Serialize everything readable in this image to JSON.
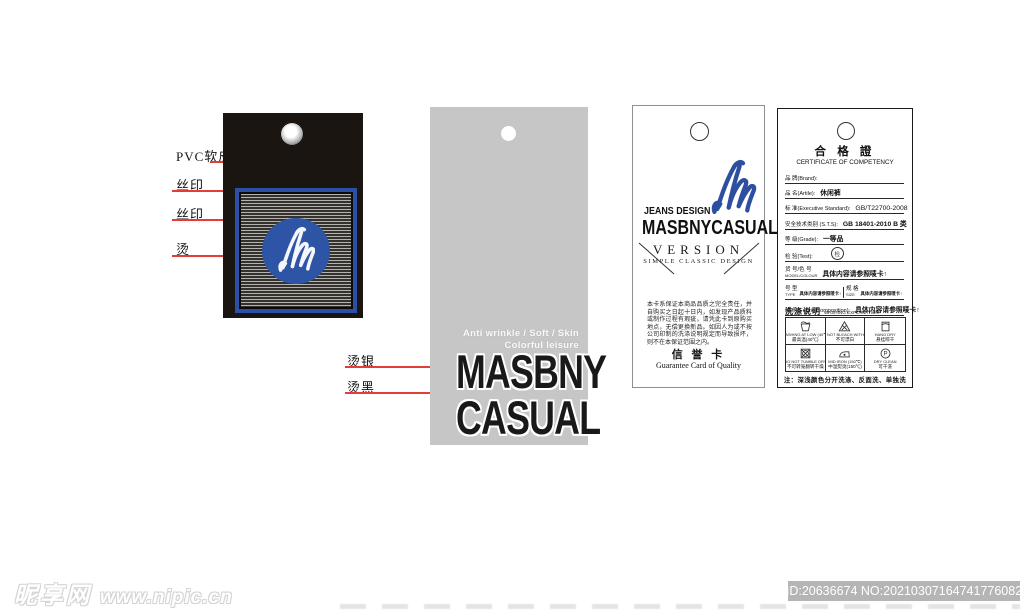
{
  "annotations": {
    "tag1": [
      {
        "label": "PVC软皮"
      },
      {
        "label": "丝印"
      },
      {
        "label": "丝印"
      },
      {
        "label": "烫"
      }
    ],
    "tag2": [
      {
        "label": "烫银"
      },
      {
        "label": "烫黑"
      }
    ]
  },
  "tag2": {
    "tagline_line1": "Anti wrinkle / Soft / Skin",
    "tagline_line2": "Colorful leisure",
    "brand_line1": "MASBNY",
    "brand_line2": "CASUAL"
  },
  "tag3": {
    "kicker": "JEANS DESIGN",
    "brand": "MASBNYCASUAL",
    "version": "VERSION",
    "slogan": "SIMPLE CLASSIC DESIGN",
    "guarantee_text": "本卡系保证本商品品质之完全责任，并自购买之日起十日内，如发现产品质料或制作过程有瑕疵，请凭此卡到原购买地点，无偿更换新品。如因人为或不按公司印制的洗涤说明规定而导致损坏，则不在本保证范围之内。",
    "card_title": "信 誉 卡",
    "card_subtitle": "Guarantee Card of Quality"
  },
  "tag4": {
    "title": "合 格 證",
    "subtitle": "CERTIFICATE OF COMPETENCY",
    "fields": [
      {
        "label": "品 牌(Brand):",
        "value": ""
      },
      {
        "label": "品 名(Artile):",
        "value": "休闲裤"
      },
      {
        "label": "标 准(Executive Standard):",
        "value": "GB/T22700-2008"
      },
      {
        "label": "安全技术类别 (S.T.S):",
        "value": "GB 18401-2010 B 类"
      },
      {
        "label": "等 级(Grade):",
        "value": "一等品"
      },
      {
        "label": "检 验(Test):",
        "value": "检"
      },
      {
        "label": "货 号/色 号",
        "label_sub": "MODEL/COLOUR",
        "value": "具体内容请参照唛卡↑"
      },
      {
        "label": "号 型",
        "label_sub": "TYPE",
        "value": "具体内容请参照唛卡↑"
      },
      {
        "label": "规 格",
        "label_sub": "SIZE",
        "value": "具体内容请参照唛卡↑"
      },
      {
        "label": "成 份(Fabric Composition):",
        "value": "具体内容请参照唛卡↑"
      }
    ],
    "washing_title": "洗涤说明",
    "washing_subtitle": "WASHING EXPLANATION",
    "washing_icons": [
      {
        "icon": "wash-tub-40-icon",
        "en": "WASHING AT LOW (40℃)",
        "zh": "最高温(40℃)"
      },
      {
        "icon": "do-not-bleach-icon",
        "en": "DO NOT BLEACH WITH CL",
        "zh": "不可漂白"
      },
      {
        "icon": "hang-dry-icon",
        "en": "HANG DRY",
        "zh": "悬挂晾干"
      },
      {
        "icon": "do-not-tumble-dry-icon",
        "en": "DO NOT TUMBLE DRY",
        "zh": "不可转笼翻转干燥"
      },
      {
        "icon": "mid-iron-icon",
        "en": "MID IRON (150℃)",
        "zh": "中温熨烫(150℃)"
      },
      {
        "icon": "dry-clean-icon",
        "en": "DRY CLEAN",
        "zh": "可干洗"
      }
    ],
    "note": "注：深浅颜色分开洗涤、反面洗、单独洗"
  },
  "watermark": {
    "site_name": "昵享网",
    "site_url": "www.nipic.cn",
    "id_label": "ID:20636674 NO:20210307164741776082"
  },
  "colors": {
    "tag1_bg": "#1b1511",
    "accent_blue": "#2b50a5",
    "tag2_bg": "#c6c6c6",
    "annotation_red": "#e63c38",
    "id_box_bg": "#b5b5b5"
  }
}
